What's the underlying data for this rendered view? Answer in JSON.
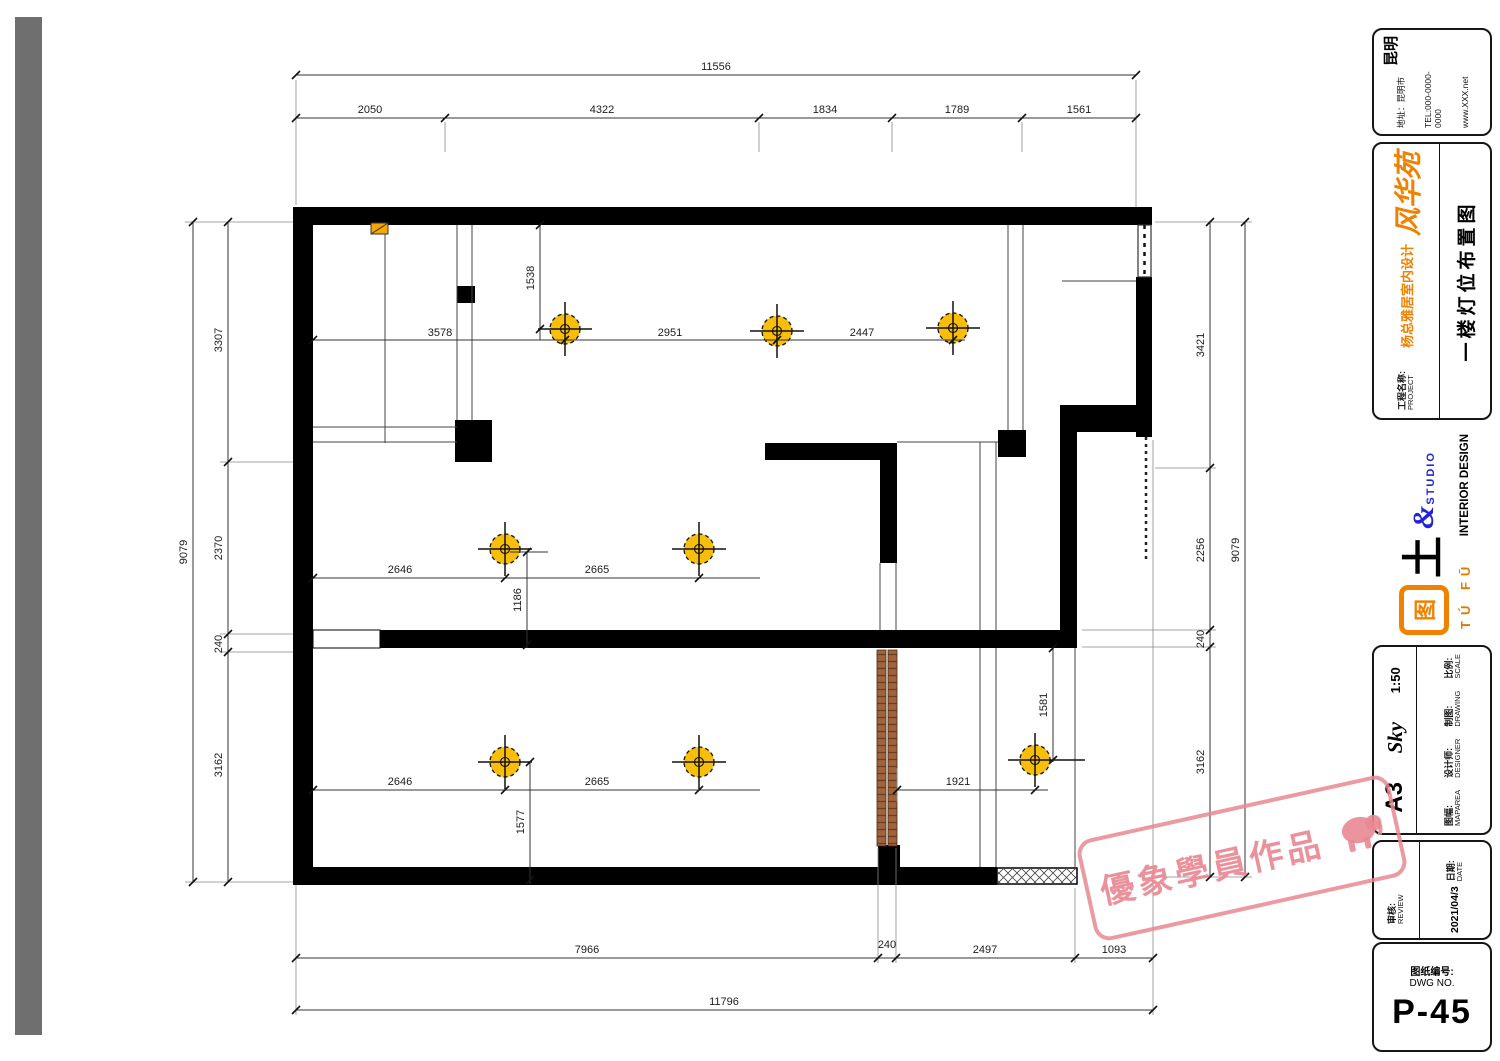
{
  "dims": {
    "top": {
      "overall": "11556",
      "segments": [
        "2050",
        "4322",
        "1834",
        "1789",
        "1561"
      ]
    },
    "bottom": {
      "overall": "11796",
      "segments": [
        "7966",
        "240",
        "2497",
        "1093"
      ]
    },
    "left": {
      "overall": "9079",
      "segments": [
        "3307",
        "2370",
        "240",
        "3162"
      ]
    },
    "right": {
      "overall": "9079",
      "segments": [
        "3421",
        "2256",
        "240",
        "3162"
      ]
    },
    "interior": {
      "v1538": "1538",
      "r1a": "3578",
      "r1b": "2951",
      "r1c": "2447",
      "r2a": "2646",
      "r2b": "2665",
      "r2v": "1186",
      "r3a": "2646",
      "r3b": "2665",
      "r3v": "1577",
      "br_h": "1921",
      "br_v": "1581"
    }
  },
  "titleblock": {
    "card": {
      "region": "昆明",
      "address": "地址：昆明市",
      "tel": "TEL:000-0000-0000",
      "web": "www.XXX.net"
    },
    "project": {
      "label_cn": "工程名称:",
      "label_en": "PROJECT",
      "brand": "风华苑",
      "subtitle": "杨总雅居室内设计",
      "title": "一楼灯位布置图"
    },
    "logo": {
      "mark": "图",
      "fu": "土",
      "amp": "&",
      "studio": "STUDIO",
      "pinyin": "TÚ FŪ",
      "tagline": "INTERIOR DESIGN"
    },
    "info": {
      "scale_cn": "比例:",
      "scale_en": "SCALE",
      "scale_val": "1:50",
      "draw_cn": "制图:",
      "draw_en": "DRAWING",
      "designer_cn": "设计师:",
      "designer_en": "DESIGNER",
      "designer_val": "Sky",
      "size_cn": "图幅:",
      "size_en": "MAPAREA",
      "size_val": "A3"
    },
    "date": {
      "date_cn": "日期:",
      "date_en": "DATE",
      "date_val": "2021/04/3",
      "review_cn": "审核:",
      "review_en": "REVIEW"
    },
    "dwg": {
      "label_cn": "图纸编号:",
      "label_en": "DWG NO.",
      "value": "P-45"
    }
  },
  "watermark": {
    "text": "優象學員作品"
  }
}
